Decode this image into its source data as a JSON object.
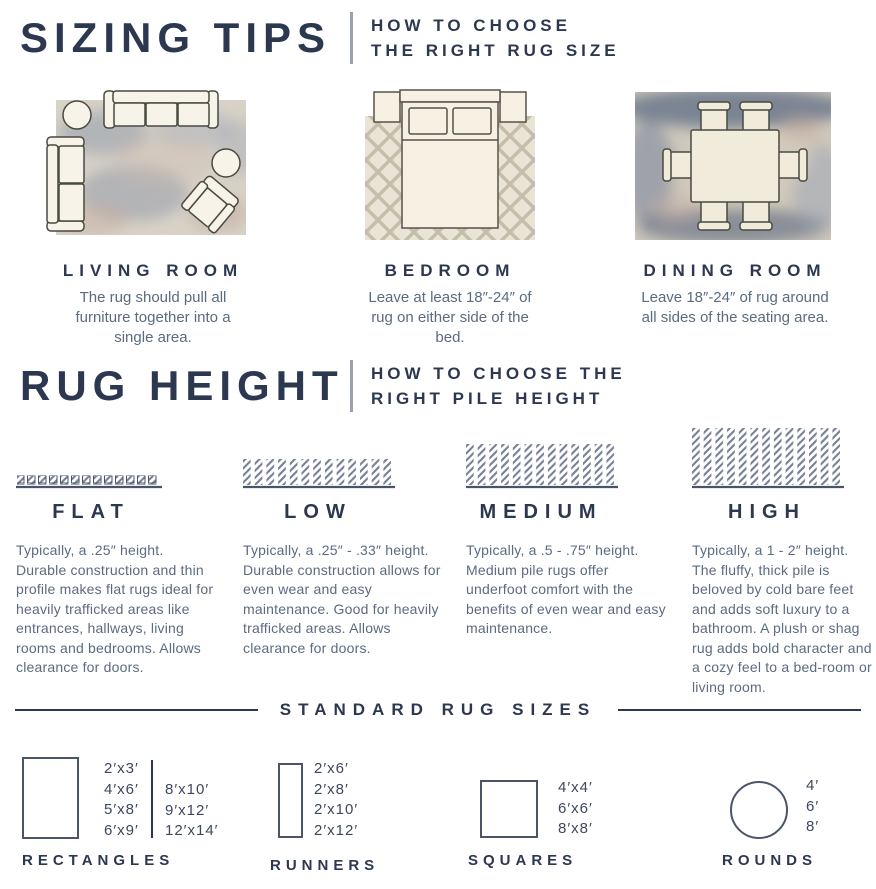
{
  "colors": {
    "heading": "#2c3850",
    "body_text": "#5b6b80",
    "divider_gray": "#9aa1ad",
    "rug_beige": "#d8d2c7",
    "rug_navy": "#5e6c86",
    "furniture_cream": "#f8f3e8"
  },
  "sizing_tips": {
    "title": "SIZING TIPS",
    "subtitle_line1": "HOW TO CHOOSE",
    "subtitle_line2": "THE RIGHT RUG SIZE",
    "rooms": [
      {
        "name": "LIVING ROOM",
        "description": "The rug should pull all furniture together into a single area.",
        "illustration": "living-room-top-view"
      },
      {
        "name": "BEDROOM",
        "description": "Leave at least 18″-24″ of rug on either side of the bed.",
        "illustration": "bedroom-top-view"
      },
      {
        "name": "DINING ROOM",
        "description": "Leave 18″-24″ of rug around all sides of the seating area.",
        "illustration": "dining-room-top-view"
      }
    ]
  },
  "rug_height": {
    "title": "RUG HEIGHT",
    "subtitle_line1": "HOW TO CHOOSE THE",
    "subtitle_line2": "RIGHT PILE HEIGHT",
    "piles": [
      {
        "name": "FLAT",
        "description": "Typically, a .25″ height. Durable construction and thin profile makes flat rugs ideal for heavily trafficked areas like entrances, hallways, living rooms and bedrooms. Allows clearance for doors."
      },
      {
        "name": "LOW",
        "description": "Typically, a .25″ - .33″ height. Durable construction allows for even wear and easy maintenance. Good for heavily trafficked areas. Allows clearance for doors."
      },
      {
        "name": "MEDIUM",
        "description": "Typically, a .5 - .75″ height. Medium pile rugs offer underfoot comfort with the benefits of even wear and easy maintenance."
      },
      {
        "name": "HIGH",
        "description": "Typically, a 1 - 2″ height. The fluffy, thick pile is beloved by cold bare feet and adds soft luxury to a bathroom. A plush or shag rug adds bold character and a cozy feel to a bed-room or living room."
      }
    ]
  },
  "standard_sizes": {
    "title": "STANDARD RUG SIZES",
    "groups": [
      {
        "label": "RECTANGLES",
        "shape": "rectangle",
        "sizes_col1": [
          "2′x3′",
          "4′x6′",
          "5′x8′",
          "6′x9′"
        ],
        "sizes_col2": [
          "8′x10′",
          "9′x12′",
          "12′x14′"
        ]
      },
      {
        "label": "RUNNERS",
        "shape": "runner",
        "sizes": [
          "2′x6′",
          "2′x8′",
          "2′x10′",
          "2′x12′"
        ]
      },
      {
        "label": "SQUARES",
        "shape": "square",
        "sizes": [
          "4′x4′",
          "6′x6′",
          "8′x8′"
        ]
      },
      {
        "label": "ROUNDS",
        "shape": "round",
        "sizes": [
          "4′",
          "6′",
          "8′"
        ]
      }
    ]
  }
}
